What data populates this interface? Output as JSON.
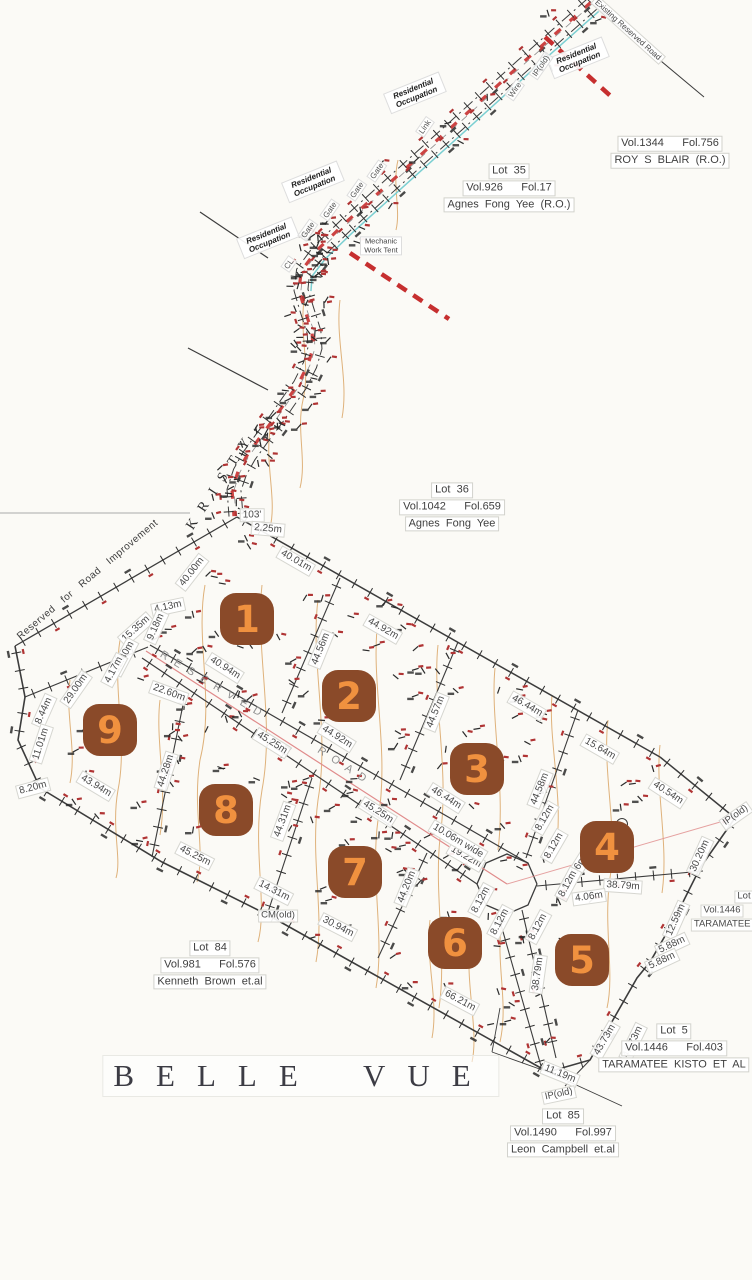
{
  "area_title": {
    "text": "BELLE VUE"
  },
  "colors": {
    "paper": "#fbfaf6",
    "ink": "#3c3c3c",
    "contour": "#d9a465",
    "road_red": "#c62f2f",
    "fence": "#7bcfd2",
    "centerline": "#e08b8b",
    "badge_bg": "#8a4a29",
    "badge_num": "#f0913f",
    "label": "#4a4a4a",
    "mark_red": "#b03434",
    "road_name": "#8f8f8f"
  },
  "badges": [
    {
      "n": "1",
      "x": 247,
      "y": 619
    },
    {
      "n": "2",
      "x": 349,
      "y": 696
    },
    {
      "n": "3",
      "x": 477,
      "y": 769
    },
    {
      "n": "4",
      "x": 607,
      "y": 847
    },
    {
      "n": "5",
      "x": 582,
      "y": 960
    },
    {
      "n": "6",
      "x": 455,
      "y": 943
    },
    {
      "n": "7",
      "x": 355,
      "y": 872
    },
    {
      "n": "8",
      "x": 226,
      "y": 810
    },
    {
      "n": "9",
      "x": 110,
      "y": 730
    }
  ],
  "measurements": [
    {
      "t": "103'",
      "x": 252,
      "y": 515,
      "r": 0
    },
    {
      "t": "2.25m",
      "x": 268,
      "y": 529,
      "r": 5
    },
    {
      "t": "40.00m",
      "x": 192,
      "y": 572,
      "r": -52
    },
    {
      "t": "40.01m",
      "x": 296,
      "y": 561,
      "r": 30
    },
    {
      "t": "4.13m",
      "x": 168,
      "y": 607,
      "r": -12
    },
    {
      "t": "15.35m",
      "x": 136,
      "y": 629,
      "r": -42
    },
    {
      "t": "9.18m",
      "x": 156,
      "y": 627,
      "r": -66
    },
    {
      "t": "12.40m",
      "x": 124,
      "y": 657,
      "r": -62
    },
    {
      "t": "4.17m",
      "x": 114,
      "y": 670,
      "r": -62
    },
    {
      "t": "29.00m",
      "x": 76,
      "y": 689,
      "r": -55
    },
    {
      "t": "22.60m",
      "x": 169,
      "y": 693,
      "r": 20
    },
    {
      "t": "8.44m",
      "x": 44,
      "y": 711,
      "r": -66
    },
    {
      "t": "11.01m",
      "x": 41,
      "y": 744,
      "r": -72
    },
    {
      "t": "8.20m",
      "x": 33,
      "y": 788,
      "r": -15
    },
    {
      "t": "43.94m",
      "x": 96,
      "y": 786,
      "r": 31
    },
    {
      "t": "44.28m",
      "x": 166,
      "y": 771,
      "r": -72
    },
    {
      "t": "40.94m",
      "x": 225,
      "y": 668,
      "r": 32
    },
    {
      "t": "44.56m",
      "x": 321,
      "y": 649,
      "r": -68
    },
    {
      "t": "44.92m",
      "x": 383,
      "y": 629,
      "r": 30
    },
    {
      "t": "44.92m",
      "x": 337,
      "y": 737,
      "r": 32
    },
    {
      "t": "45.25m",
      "x": 272,
      "y": 743,
      "r": 32
    },
    {
      "t": "46.44m",
      "x": 527,
      "y": 706,
      "r": 30
    },
    {
      "t": "44.57m",
      "x": 436,
      "y": 712,
      "r": -68
    },
    {
      "t": "15.64m",
      "x": 600,
      "y": 749,
      "r": 30
    },
    {
      "t": "46.44m",
      "x": 446,
      "y": 798,
      "r": 32
    },
    {
      "t": "44.58m",
      "x": 540,
      "y": 789,
      "r": -68
    },
    {
      "t": "40.54m",
      "x": 668,
      "y": 793,
      "r": 33
    },
    {
      "t": "30.20m",
      "x": 700,
      "y": 856,
      "r": -66
    },
    {
      "t": "38.79m",
      "x": 623,
      "y": 886,
      "r": 4
    },
    {
      "t": "4.06m",
      "x": 589,
      "y": 897,
      "r": -8
    },
    {
      "t": "4.06m",
      "x": 577,
      "y": 869,
      "r": -58
    },
    {
      "t": "12.59m",
      "x": 676,
      "y": 920,
      "r": -66
    },
    {
      "t": "5.88m",
      "x": 672,
      "y": 945,
      "r": -25
    },
    {
      "t": "5.88m",
      "x": 662,
      "y": 961,
      "r": -25
    },
    {
      "t": "8.12m",
      "x": 545,
      "y": 818,
      "r": -60
    },
    {
      "t": "8.12m",
      "x": 554,
      "y": 846,
      "r": -60
    },
    {
      "t": "8.12m",
      "x": 568,
      "y": 884,
      "r": -62
    },
    {
      "t": "8.12m",
      "x": 481,
      "y": 900,
      "r": -62
    },
    {
      "t": "8.12m",
      "x": 500,
      "y": 922,
      "r": -62
    },
    {
      "t": "8.12m",
      "x": 538,
      "y": 927,
      "r": -62
    },
    {
      "t": "19.22m",
      "x": 466,
      "y": 857,
      "r": 30
    },
    {
      "t": "10.06m wide",
      "x": 458,
      "y": 841,
      "r": 31
    },
    {
      "t": "45.25m",
      "x": 378,
      "y": 812,
      "r": 32
    },
    {
      "t": "45.25m",
      "x": 195,
      "y": 856,
      "r": 27
    },
    {
      "t": "44.31m",
      "x": 283,
      "y": 821,
      "r": -70
    },
    {
      "t": "14.31m",
      "x": 274,
      "y": 891,
      "r": 27
    },
    {
      "t": "30.94m",
      "x": 338,
      "y": 927,
      "r": 27
    },
    {
      "t": "44.20m",
      "x": 407,
      "y": 887,
      "r": -68
    },
    {
      "t": "66.21m",
      "x": 460,
      "y": 1001,
      "r": 28
    },
    {
      "t": "38.79m",
      "x": 538,
      "y": 974,
      "r": -82
    },
    {
      "t": "43.73m",
      "x": 605,
      "y": 1040,
      "r": -60
    },
    {
      "t": "41.73m",
      "x": 633,
      "y": 1042,
      "r": -64
    },
    {
      "t": "11.19m",
      "x": 560,
      "y": 1074,
      "r": 22
    }
  ],
  "notes": [
    {
      "t": "Existing Reserved Road",
      "x": 628,
      "y": 30,
      "r": 42,
      "c": "n-box n-sm"
    },
    {
      "t": "Residential Occupation",
      "x": 578,
      "y": 58,
      "r": -22,
      "c": "n-resocc"
    },
    {
      "t": "Residential Occupation",
      "x": 415,
      "y": 93,
      "r": -22,
      "c": "n-resocc"
    },
    {
      "t": "Residential Occupation",
      "x": 313,
      "y": 182,
      "r": -22,
      "c": "n-resocc"
    },
    {
      "t": "Residential Occupation",
      "x": 268,
      "y": 238,
      "r": -22,
      "c": "n-resocc"
    },
    {
      "t": "Mechanic Work Tent",
      "x": 381,
      "y": 246,
      "r": 0,
      "c": "n-mech"
    },
    {
      "t": "Gate",
      "x": 377,
      "y": 171,
      "r": -55,
      "c": "n-sm2"
    },
    {
      "t": "Gate",
      "x": 357,
      "y": 190,
      "r": -55,
      "c": "n-sm2"
    },
    {
      "t": "Gate",
      "x": 330,
      "y": 210,
      "r": -55,
      "c": "n-sm2"
    },
    {
      "t": "Gate",
      "x": 308,
      "y": 230,
      "r": -55,
      "c": "n-sm2"
    },
    {
      "t": "Wire",
      "x": 515,
      "y": 90,
      "r": -55,
      "c": "n-sm2"
    },
    {
      "t": "Link",
      "x": 425,
      "y": 127,
      "r": -55,
      "c": "n-sm2"
    },
    {
      "t": "CL",
      "x": 289,
      "y": 264,
      "r": -55,
      "c": "n-sm2"
    },
    {
      "t": "IP(old)",
      "x": 541,
      "y": 66,
      "r": -55,
      "c": "n-sm2"
    },
    {
      "t": "IP(old)",
      "x": 736,
      "y": 816,
      "r": -35,
      "c": "n-box"
    },
    {
      "t": "IP(old)",
      "x": 559,
      "y": 1095,
      "r": -12,
      "c": "n-box"
    },
    {
      "t": "CM(old)",
      "x": 278,
      "y": 916,
      "r": 0,
      "c": "n-box"
    },
    {
      "t": "KRISTY",
      "x": 222,
      "y": 480,
      "r": -57,
      "c": "n-kristy"
    },
    {
      "t": "Reserved for Road Improvement",
      "x": 88,
      "y": 580,
      "r": -40,
      "c": "n-resimp"
    },
    {
      "t": "RESERVED",
      "x": 214,
      "y": 686,
      "r": 31,
      "c": "n-road"
    },
    {
      "t": "ROAD",
      "x": 345,
      "y": 767,
      "r": 33,
      "c": "n-road"
    },
    {
      "t": "Lot",
      "x": 744,
      "y": 897,
      "r": 0,
      "c": "n-box"
    },
    {
      "t": "Vol.1446",
      "x": 722,
      "y": 911,
      "r": 0,
      "c": "n-box"
    },
    {
      "t": "TARAMATEE  K",
      "x": 728,
      "y": 925,
      "r": 0,
      "c": "n-box"
    }
  ],
  "parcels": [
    {
      "x": 670,
      "y": 152,
      "lines": [
        "Vol.1344      Fol.756",
        "ROY  S  BLAIR  (R.O.)"
      ]
    },
    {
      "x": 509,
      "y": 188,
      "lines": [
        "Lot  35",
        "Vol.926      Fol.17",
        "Agnes  Fong  Yee  (R.O.)"
      ]
    },
    {
      "x": 452,
      "y": 507,
      "lines": [
        "Lot  36",
        "Vol.1042      Fol.659",
        "Agnes  Fong  Yee"
      ]
    },
    {
      "x": 210,
      "y": 965,
      "lines": [
        "Lot  84",
        "Vol.981      Fol.576",
        "Kenneth  Brown  et.al"
      ]
    },
    {
      "x": 674,
      "y": 1048,
      "lines": [
        "Lot  5",
        "Vol.1446      Fol.403",
        "TARAMATEE  KISTO  ET  AL"
      ]
    },
    {
      "x": 563,
      "y": 1133,
      "lines": [
        "Lot  85",
        "Vol.1490      Fol.997",
        "Leon  Campbell  et.al"
      ]
    }
  ]
}
